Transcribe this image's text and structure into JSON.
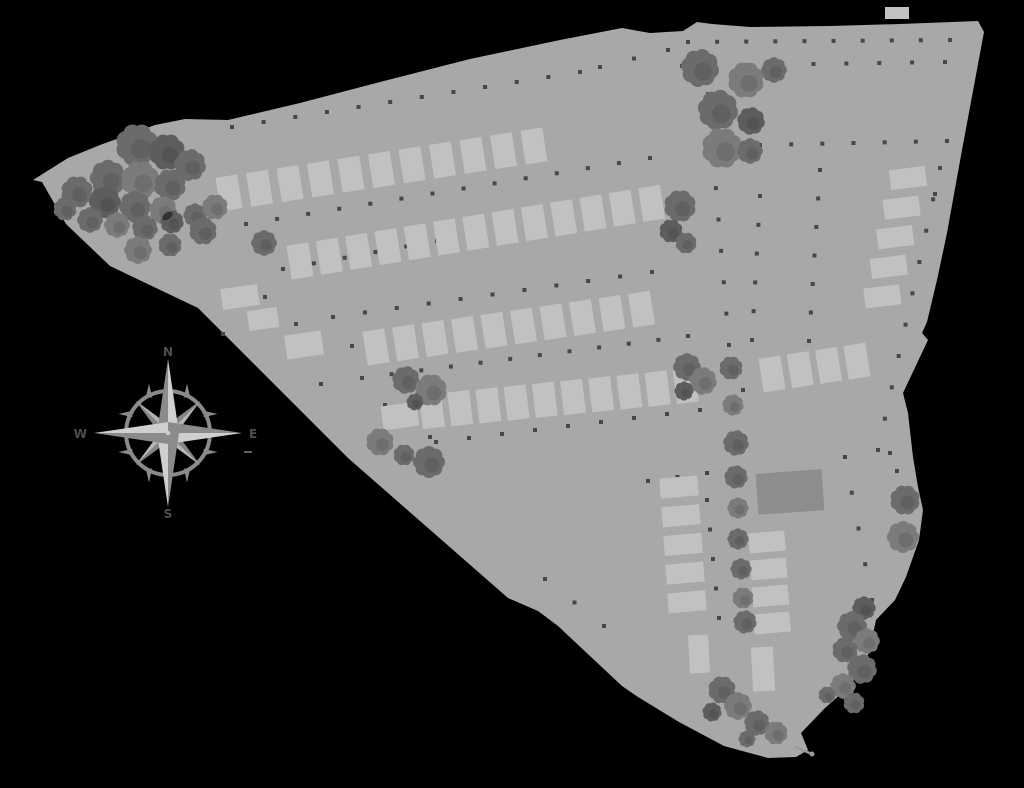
{
  "page": {
    "background": "#000000"
  },
  "plan": {
    "ground_color": "#a8a8a8",
    "lot_color": "#c1c1c1",
    "building_color": "#8d8d8d",
    "dot_color": "#474747",
    "tree_colors": [
      "#6b6b6b",
      "#7b7b7b",
      "#5d5d5d"
    ],
    "tree_overlap_color": "#2e2e2e",
    "tail_color": "#9a9a9a",
    "outline": [
      [
        33,
        180
      ],
      [
        68,
        158
      ],
      [
        100,
        145
      ],
      [
        155,
        125
      ],
      [
        185,
        119
      ],
      [
        228,
        120
      ],
      [
        300,
        103
      ],
      [
        380,
        82
      ],
      [
        470,
        59
      ],
      [
        560,
        40
      ],
      [
        622,
        28
      ],
      [
        650,
        33
      ],
      [
        683,
        31
      ],
      [
        697,
        22
      ],
      [
        712,
        24
      ],
      [
        750,
        27
      ],
      [
        830,
        26
      ],
      [
        900,
        24
      ],
      [
        978,
        21
      ],
      [
        984,
        32
      ],
      [
        962,
        150
      ],
      [
        947,
        233
      ],
      [
        937,
        280
      ],
      [
        927,
        322
      ],
      [
        922,
        333
      ],
      [
        928,
        340
      ],
      [
        903,
        393
      ],
      [
        908,
        413
      ],
      [
        913,
        457
      ],
      [
        918,
        487
      ],
      [
        923,
        510
      ],
      [
        919,
        540
      ],
      [
        906,
        577
      ],
      [
        895,
        600
      ],
      [
        876,
        620
      ],
      [
        869,
        653
      ],
      [
        849,
        687
      ],
      [
        825,
        708
      ],
      [
        801,
        733
      ],
      [
        808,
        750
      ],
      [
        796,
        757
      ],
      [
        768,
        758
      ],
      [
        724,
        746
      ],
      [
        679,
        722
      ],
      [
        638,
        697
      ],
      [
        622,
        686
      ],
      [
        558,
        626
      ],
      [
        538,
        611
      ],
      [
        508,
        598
      ],
      [
        348,
        458
      ],
      [
        198,
        308
      ],
      [
        110,
        266
      ],
      [
        66,
        224
      ],
      [
        42,
        182
      ]
    ],
    "boundary_tail": {
      "x1": 795,
      "y1": 747,
      "x2": 812,
      "y2": 754
    }
  },
  "lot_rows": [
    {
      "id": "row-a",
      "count": 11,
      "cx": 229,
      "cy": 193,
      "dx": 30.5,
      "dy": -4.7,
      "w": 22,
      "h": 34,
      "angle": -9
    },
    {
      "id": "row-b",
      "count": 13,
      "cx": 300,
      "cy": 261,
      "dx": 29.3,
      "dy": -4.8,
      "w": 22,
      "h": 34,
      "angle": -9
    },
    {
      "id": "row-c",
      "count": 10,
      "cx": 376,
      "cy": 347,
      "dx": 29.5,
      "dy": -4.2,
      "w": 22,
      "h": 34,
      "angle": -9
    },
    {
      "id": "row-d",
      "count": 10,
      "cx": 432,
      "cy": 411,
      "dx": 28.2,
      "dy": -2.8,
      "w": 22,
      "h": 34,
      "angle": -7
    },
    {
      "id": "row-d-east",
      "count": 4,
      "cx": 772,
      "cy": 374,
      "dx": 28.3,
      "dy": -4.3,
      "w": 22,
      "h": 34,
      "angle": -9
    },
    {
      "id": "col-east",
      "count": 5,
      "cx": 908,
      "cy": 178,
      "dx": -6.4,
      "dy": 29.6,
      "w": 36,
      "h": 20,
      "angle": -7
    },
    {
      "id": "col-south-left",
      "count": 5,
      "cx": 679,
      "cy": 487,
      "dx": 2.0,
      "dy": 28.7,
      "w": 38,
      "h": 20,
      "angle": -5
    },
    {
      "id": "col-south-right",
      "count": 4,
      "cx": 767,
      "cy": 542,
      "dx": 1.7,
      "dy": 27.0,
      "w": 36,
      "h": 20,
      "angle": -5
    }
  ],
  "stray_lots": [
    {
      "cx": 240,
      "cy": 297,
      "w": 37,
      "h": 21,
      "angle": -8
    },
    {
      "cx": 263,
      "cy": 319,
      "w": 30,
      "h": 20,
      "angle": -8
    },
    {
      "cx": 304,
      "cy": 345,
      "w": 37,
      "h": 24,
      "angle": -8
    },
    {
      "cx": 400,
      "cy": 416,
      "w": 36,
      "h": 24,
      "angle": -8
    },
    {
      "cx": 699,
      "cy": 654,
      "w": 20,
      "h": 38,
      "angle": -3
    },
    {
      "cx": 763,
      "cy": 669,
      "w": 22,
      "h": 44,
      "angle": -3
    },
    {
      "cx": 897,
      "cy": 13,
      "w": 24,
      "h": 12,
      "angle": 0
    }
  ],
  "building": {
    "cx": 790,
    "cy": 492,
    "w": 66,
    "h": 41,
    "angle": -4
  },
  "trees": [
    [
      137,
      145,
      20,
      0
    ],
    [
      167,
      152,
      17,
      2
    ],
    [
      190,
      165,
      15,
      0
    ],
    [
      108,
      178,
      17,
      0
    ],
    [
      140,
      180,
      18,
      1
    ],
    [
      170,
      185,
      15,
      0
    ],
    [
      77,
      192,
      15,
      0
    ],
    [
      105,
      202,
      15,
      2
    ],
    [
      135,
      207,
      15,
      0
    ],
    [
      163,
      210,
      13,
      1
    ],
    [
      65,
      209,
      11,
      0
    ],
    [
      90,
      220,
      12,
      0
    ],
    [
      117,
      225,
      12,
      1
    ],
    [
      145,
      228,
      12,
      0
    ],
    [
      172,
      222,
      11,
      2
    ],
    [
      195,
      215,
      11,
      0
    ],
    [
      203,
      231,
      13,
      0
    ],
    [
      138,
      250,
      13,
      1
    ],
    [
      170,
      245,
      11,
      0
    ],
    [
      215,
      207,
      12,
      1
    ],
    [
      264,
      243,
      12,
      0
    ],
    [
      700,
      68,
      18,
      0
    ],
    [
      746,
      80,
      17,
      1
    ],
    [
      774,
      70,
      12,
      0
    ],
    [
      718,
      110,
      19,
      0
    ],
    [
      751,
      121,
      13,
      2
    ],
    [
      722,
      148,
      19,
      1
    ],
    [
      750,
      151,
      12,
      0
    ],
    [
      680,
      206,
      15,
      0
    ],
    [
      671,
      231,
      11,
      2
    ],
    [
      686,
      243,
      10,
      0
    ],
    [
      406,
      380,
      13,
      0
    ],
    [
      431,
      390,
      15,
      1
    ],
    [
      415,
      402,
      8,
      2
    ],
    [
      380,
      442,
      13,
      1
    ],
    [
      404,
      455,
      10,
      0
    ],
    [
      429,
      462,
      15,
      0
    ],
    [
      687,
      367,
      13,
      0
    ],
    [
      703,
      381,
      13,
      1
    ],
    [
      684,
      391,
      9,
      2
    ],
    [
      731,
      368,
      11,
      0
    ],
    [
      733,
      405,
      10,
      1
    ],
    [
      736,
      443,
      12,
      0
    ],
    [
      736,
      477,
      11,
      0
    ],
    [
      738,
      508,
      10,
      1
    ],
    [
      738,
      539,
      10,
      0
    ],
    [
      741,
      569,
      10,
      0
    ],
    [
      743,
      598,
      10,
      1
    ],
    [
      905,
      500,
      14,
      0
    ],
    [
      903,
      537,
      15,
      1
    ],
    [
      864,
      608,
      11,
      2
    ],
    [
      852,
      626,
      14,
      0
    ],
    [
      867,
      641,
      12,
      1
    ],
    [
      845,
      650,
      12,
      0
    ],
    [
      862,
      669,
      14,
      0
    ],
    [
      843,
      686,
      12,
      1
    ],
    [
      854,
      703,
      10,
      0
    ],
    [
      827,
      695,
      8,
      0
    ],
    [
      745,
      622,
      11,
      0
    ],
    [
      722,
      690,
      13,
      0
    ],
    [
      738,
      706,
      13,
      1
    ],
    [
      712,
      712,
      9,
      2
    ],
    [
      757,
      723,
      12,
      0
    ],
    [
      776,
      733,
      11,
      1
    ],
    [
      747,
      739,
      8,
      0
    ]
  ],
  "dot_lines": [
    [
      232,
      127,
      580,
      72,
      12
    ],
    [
      600,
      67,
      668,
      50,
      3
    ],
    [
      246,
      224,
      650,
      158,
      14
    ],
    [
      283,
      269,
      622,
      207,
      12
    ],
    [
      333,
      317,
      652,
      272,
      11
    ],
    [
      362,
      378,
      688,
      336,
      12
    ],
    [
      436,
      442,
      700,
      410,
      9
    ],
    [
      688,
      42,
      950,
      40,
      10
    ],
    [
      682,
      66,
      945,
      62,
      9
    ],
    [
      760,
      145,
      947,
      141,
      7
    ],
    [
      820,
      170,
      809,
      341,
      7
    ],
    [
      940,
      168,
      878,
      450,
      10
    ],
    [
      708,
      94,
      729,
      345,
      9
    ],
    [
      760,
      196,
      752,
      340,
      6
    ],
    [
      648,
      481,
      707,
      473,
      3
    ],
    [
      707,
      500,
      719,
      618,
      5
    ],
    [
      845,
      457,
      872,
      600,
      5
    ],
    [
      545,
      579,
      604,
      626,
      3
    ],
    [
      743,
      390,
      860,
      372,
      5
    ]
  ],
  "dots": [
    [
      265,
      297
    ],
    [
      296,
      324
    ],
    [
      223,
      334
    ],
    [
      321,
      384
    ],
    [
      352,
      346
    ],
    [
      385,
      405
    ],
    [
      430,
      437
    ],
    [
      890,
      453
    ],
    [
      897,
      471
    ],
    [
      935,
      194
    ]
  ],
  "compass": {
    "cx": 168,
    "cy": 433,
    "point_length": 74,
    "point_halfwidth": 11,
    "diag_length": 46,
    "diag_halfwidth": 7,
    "ring_radius": 42,
    "labels": {
      "n": "N",
      "e": "E",
      "s": "S",
      "w": "W"
    },
    "light": "#cfcfcf",
    "dark": "#8b8b8b",
    "diag_light": "#b5b5b5",
    "diag_dark": "#868686",
    "ring_color": "#8a8a8a",
    "label_color": "#4f4f4f",
    "tick": {
      "x1": 244,
      "y1": 452,
      "x2": 252,
      "y2": 452
    }
  }
}
